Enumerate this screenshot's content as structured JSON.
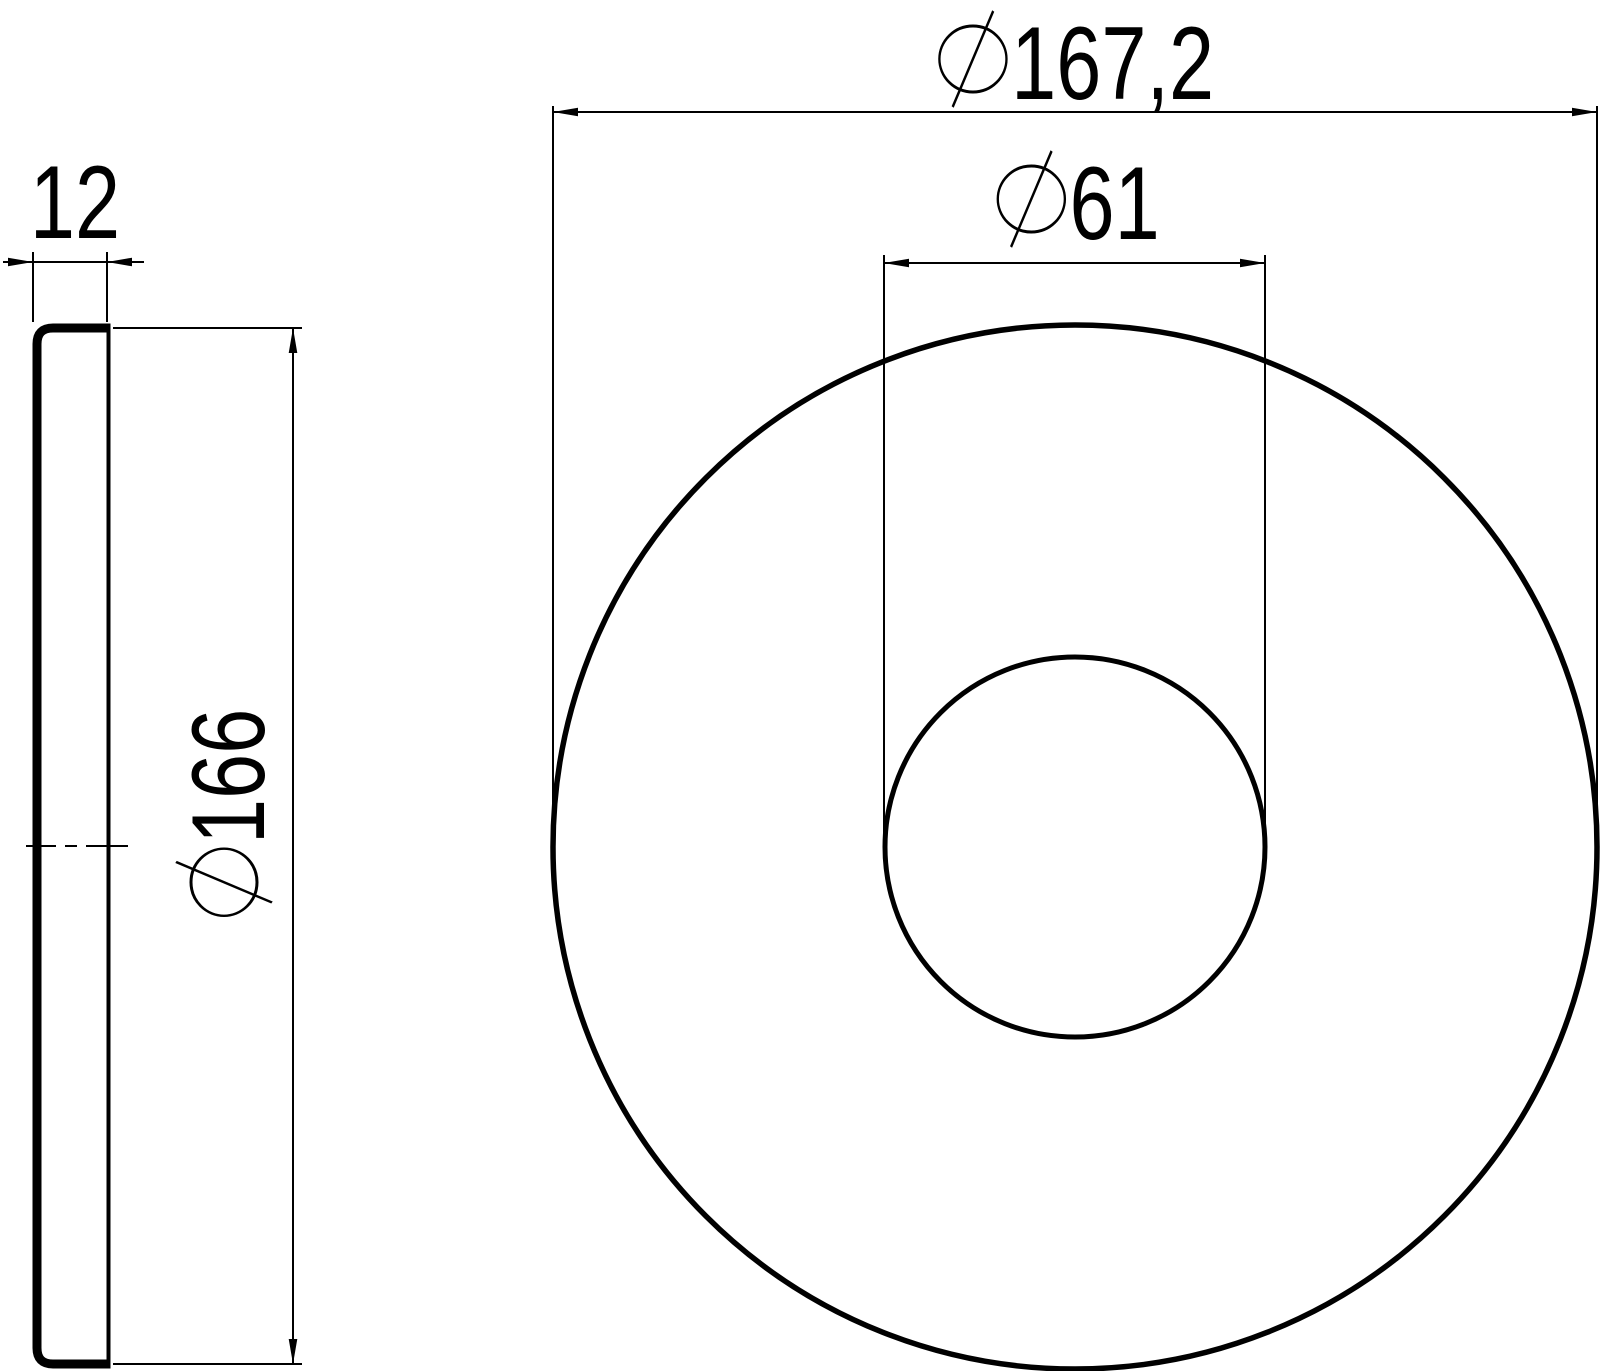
{
  "drawing": {
    "colors": {
      "line": "#000000",
      "background": "#ffffff"
    },
    "views": {
      "side_view": "part-profile",
      "front_view": "part-face"
    },
    "dimensions": {
      "thickness": {
        "value": "12"
      },
      "side_diameter": {
        "symbol": "⌀",
        "value": "166",
        "full_label": "⌀166"
      },
      "outer_diameter": {
        "symbol": "⌀",
        "value": "167,2",
        "full_label": "⌀167,2"
      },
      "bore_diameter": {
        "symbol": "⌀",
        "value": "61",
        "full_label": "⌀61"
      }
    }
  }
}
